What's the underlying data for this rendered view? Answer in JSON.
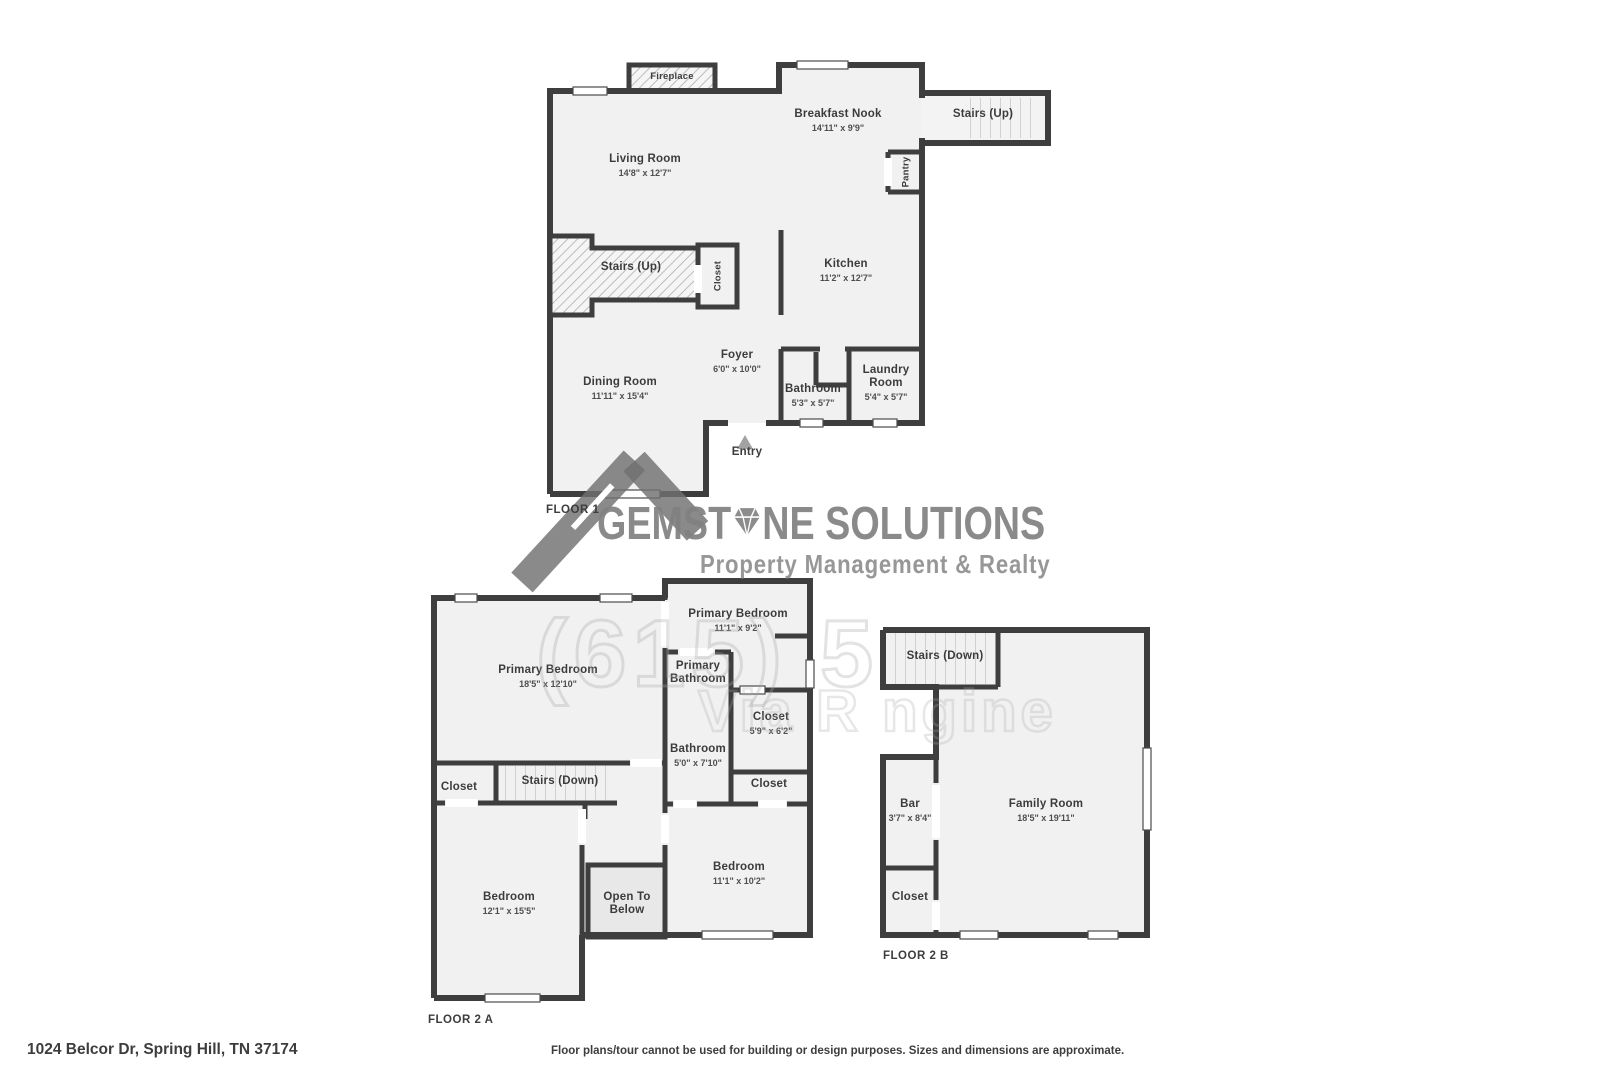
{
  "page": {
    "address": "1024 Belcor Dr, Spring Hill, TN 37174",
    "disclaimer": "Floor plans/tour cannot be used for building or design purposes. Sizes and dimensions are approximate."
  },
  "watermark": {
    "brand_prefix": "GEMST",
    "brand_suffix": "NE SOLUTIONS",
    "tagline": "Property Management & Realty",
    "phone_fragment": "(615) 5",
    "engine_fragment": "Via R ngine",
    "brand_color": "#8c8c8c",
    "wall_color": "#3e3e3e",
    "room_fill": "#f1f1f1"
  },
  "floor1": {
    "label": "FLOOR 1",
    "rooms": {
      "fireplace": {
        "name": "Fireplace"
      },
      "breakfast_nook": {
        "name": "Breakfast Nook",
        "dims": "14'11\" x 9'9\""
      },
      "stairs_up_wing": {
        "name": "Stairs (Up)"
      },
      "living_room": {
        "name": "Living Room",
        "dims": "14'8\" x 12'7\""
      },
      "pantry": {
        "name": "Pantry"
      },
      "stairs_up": {
        "name": "Stairs (Up)"
      },
      "closet": {
        "name": "Closet"
      },
      "kitchen": {
        "name": "Kitchen",
        "dims": "11'2\" x 12'7\""
      },
      "foyer": {
        "name": "Foyer",
        "dims": "6'0\" x 10'0\""
      },
      "dining_room": {
        "name": "Dining Room",
        "dims": "11'11\" x 15'4\""
      },
      "bathroom": {
        "name": "Bathroom",
        "dims": "5'3\" x 5'7\""
      },
      "laundry_room": {
        "name": "Laundry Room",
        "dims": "5'4\" x 5'7\""
      },
      "entry": {
        "name": "Entry"
      }
    }
  },
  "floor2a": {
    "label": "FLOOR 2 A",
    "rooms": {
      "primary_bedroom_large": {
        "name": "Primary Bedroom",
        "dims": "18'5\" x 12'10\""
      },
      "primary_bedroom_small": {
        "name": "Primary Bedroom",
        "dims": "11'1\" x 9'2\""
      },
      "primary_bathroom": {
        "name": "Primary Bathroom"
      },
      "closet_upper": {
        "name": "Closet",
        "dims": "5'9\" x 6'2\""
      },
      "bathroom": {
        "name": "Bathroom",
        "dims": "5'0\" x 7'10\""
      },
      "closet_left": {
        "name": "Closet"
      },
      "stairs_down": {
        "name": "Stairs (Down)"
      },
      "closet_right": {
        "name": "Closet"
      },
      "bedroom_left": {
        "name": "Bedroom",
        "dims": "12'1\" x 15'5\""
      },
      "open_to_below": {
        "name": "Open To Below"
      },
      "bedroom_right": {
        "name": "Bedroom",
        "dims": "11'1\" x 10'2\""
      }
    }
  },
  "floor2b": {
    "label": "FLOOR 2 B",
    "rooms": {
      "stairs_down": {
        "name": "Stairs (Down)"
      },
      "bar": {
        "name": "Bar",
        "dims": "3'7\" x 8'4\""
      },
      "family_room": {
        "name": "Family Room",
        "dims": "18'5\" x 19'11\""
      },
      "closet": {
        "name": "Closet"
      }
    }
  }
}
